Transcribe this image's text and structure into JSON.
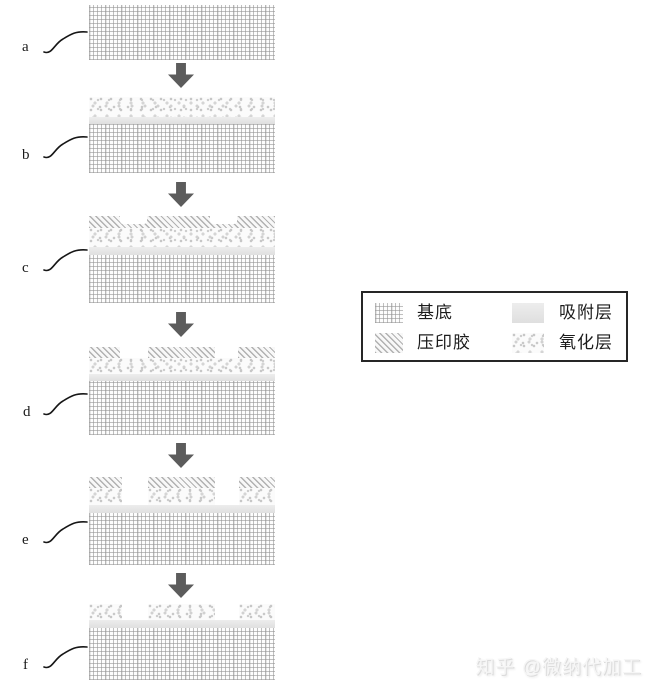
{
  "figure": {
    "type": "process-flow-diagram",
    "description": "Nanoimprint lithography process cross-sections, six steps top to bottom connected by downward arrows",
    "flow_direction": "down",
    "arrow_icon": "down-arrow",
    "steps": [
      {
        "label": "a",
        "layers_top_to_bottom": [
          "基底"
        ]
      },
      {
        "label": "b",
        "layers_top_to_bottom": [
          "氧化层",
          "吸附层",
          "基底"
        ]
      },
      {
        "label": "c",
        "layers_top_to_bottom": [
          "压印胶 (带两个压印凹槽)",
          "氧化层",
          "吸附层",
          "基底"
        ]
      },
      {
        "label": "d",
        "layers_top_to_bottom": [
          "压印胶 (三段图形化)",
          "氧化层",
          "吸附层",
          "基底"
        ]
      },
      {
        "label": "e",
        "layers_top_to_bottom": [
          "压印胶 (三段)",
          "氧化层 (三段)",
          "吸附层",
          "基底"
        ]
      },
      {
        "label": "f",
        "layers_top_to_bottom": [
          "氧化层 (三段)",
          "吸附层",
          "基底"
        ]
      }
    ]
  },
  "legend": {
    "items": [
      {
        "label": "基底",
        "pattern": "crosshatch-grid"
      },
      {
        "label": "吸附层",
        "pattern": "solid-light-gray"
      },
      {
        "label": "压印胶",
        "pattern": "diagonal-hatch"
      },
      {
        "label": "氧化层",
        "pattern": "stipple-speckle"
      }
    ]
  },
  "watermark": {
    "text": "知乎 @微纳代加工"
  },
  "colors": {
    "background": "#ffffff",
    "arrow": "#5c5c5c",
    "pattern_gray_layer": "#e4e4e4",
    "pattern_lines": "#b1b1b1",
    "legend_border": "#262626",
    "text": "#1a1a1a",
    "watermark_text": "#e0e0e0"
  }
}
